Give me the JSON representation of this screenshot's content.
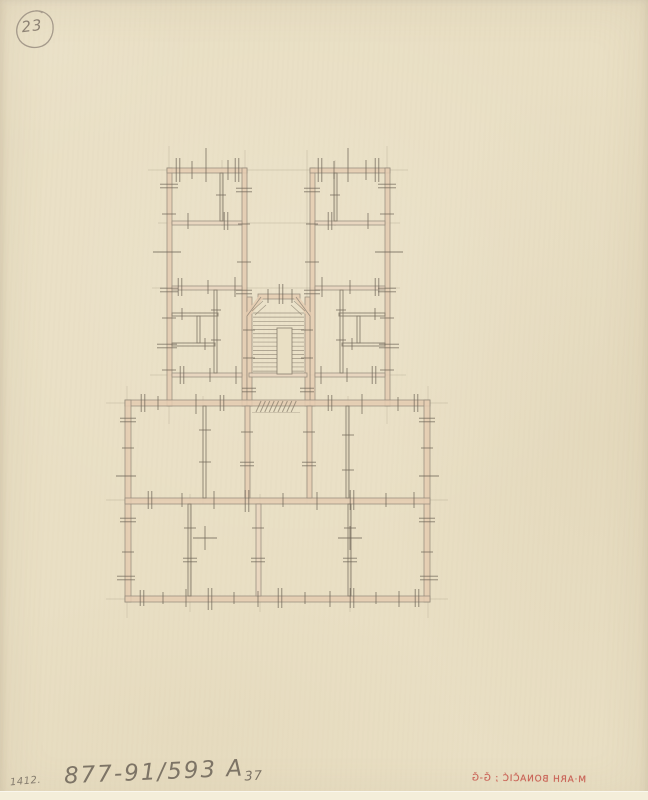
{
  "annotations": {
    "sheet_number": "23",
    "index_number": "1412.",
    "catalog_number": "877-91/593 A",
    "catalog_suffix": "37",
    "stamp_text": "M·ARH BONAČIĆ ; Ǧ-Ǧ"
  },
  "colors": {
    "paper": "#e9dfc4",
    "wall_fill": "#e5ccb2",
    "wall_fill_light": "#ead6c0",
    "wall_edge": "#94897a",
    "pencil": "#847a6a",
    "tick": "#6e6557",
    "construction": "#aba08a",
    "badge_line": "#a59a8b",
    "stamp_red": "#c3473e"
  },
  "floor_plan": {
    "walls": [
      [
        167,
        168,
        5,
        238,
        "p"
      ],
      [
        167,
        168,
        80,
        5,
        "p"
      ],
      [
        242,
        168,
        5,
        238,
        "p"
      ],
      [
        310,
        168,
        5,
        238,
        "p"
      ],
      [
        310,
        168,
        80,
        5,
        "p"
      ],
      [
        385,
        168,
        5,
        238,
        "p"
      ],
      [
        247,
        297,
        5,
        109,
        "p"
      ],
      [
        258,
        294,
        42,
        5,
        "p"
      ],
      [
        305,
        297,
        5,
        109,
        "p"
      ],
      [
        249,
        373,
        58,
        4,
        "P"
      ],
      [
        172,
        221,
        70,
        4,
        "P"
      ],
      [
        315,
        221,
        70,
        4,
        "P"
      ],
      [
        172,
        286,
        70,
        4,
        "P"
      ],
      [
        315,
        286,
        70,
        4,
        "P"
      ],
      [
        172,
        373,
        70,
        4,
        "P"
      ],
      [
        315,
        373,
        70,
        4,
        "P"
      ],
      [
        125,
        400,
        305,
        6,
        "p"
      ],
      [
        125,
        400,
        6,
        202,
        "p"
      ],
      [
        424,
        400,
        6,
        202,
        "p"
      ],
      [
        125,
        596,
        305,
        6,
        "p"
      ],
      [
        125,
        498,
        305,
        6,
        "p"
      ],
      [
        245,
        406,
        5,
        92,
        "p"
      ],
      [
        307,
        406,
        5,
        92,
        "p"
      ],
      [
        256,
        504,
        5,
        92,
        "P"
      ],
      [
        220,
        173,
        3,
        48,
        "g"
      ],
      [
        334,
        173,
        3,
        48,
        "g"
      ],
      [
        172,
        313,
        46,
        3,
        "g"
      ],
      [
        339,
        313,
        46,
        3,
        "g"
      ],
      [
        214,
        290,
        3,
        83,
        "g"
      ],
      [
        340,
        290,
        3,
        83,
        "g"
      ],
      [
        172,
        343,
        43,
        3,
        "g"
      ],
      [
        342,
        343,
        43,
        3,
        "g"
      ],
      [
        197,
        316,
        3,
        27,
        "g"
      ],
      [
        357,
        316,
        3,
        27,
        "g"
      ],
      [
        203,
        406,
        3,
        92,
        "g"
      ],
      [
        346,
        406,
        3,
        92,
        "g"
      ],
      [
        188,
        504,
        3,
        92,
        "g"
      ],
      [
        348,
        504,
        3,
        92,
        "g"
      ]
    ],
    "construction": [
      [
        "h",
        170,
        148,
        408
      ],
      [
        "h",
        223,
        158,
        400
      ],
      [
        "h",
        288,
        152,
        400
      ],
      [
        "h",
        375,
        150,
        406
      ],
      [
        "h",
        403,
        106,
        448
      ],
      [
        "h",
        500,
        106,
        448
      ],
      [
        "h",
        599,
        106,
        448
      ],
      [
        "v",
        127,
        386,
        618
      ],
      [
        "v",
        169,
        146,
        424
      ],
      [
        "v",
        245,
        150,
        504
      ],
      [
        "v",
        307,
        150,
        504
      ],
      [
        "v",
        387,
        146,
        424
      ],
      [
        "v",
        428,
        386,
        618
      ],
      [
        "v",
        203,
        396,
        504
      ],
      [
        "v",
        348,
        396,
        504
      ],
      [
        "v",
        190,
        494,
        612
      ],
      [
        "v",
        260,
        494,
        612
      ],
      [
        "v",
        350,
        494,
        612
      ],
      [
        "v",
        222,
        160,
        226
      ],
      [
        "v",
        335,
        160,
        226
      ]
    ],
    "chamfers": [
      [
        247,
        316,
        261,
        297
      ],
      [
        310,
        316,
        296,
        297
      ]
    ],
    "stair": {
      "x1": 253,
      "x2": 304,
      "y_start": 313,
      "count": 15,
      "step": 4.15,
      "well": [
        277,
        328,
        15,
        46
      ],
      "extra": [
        [
          252,
          311,
          263,
          301
        ],
        [
          305,
          311,
          294,
          301
        ],
        [
          255,
          315,
          266,
          305
        ],
        [
          302,
          315,
          291,
          305
        ]
      ]
    },
    "hatch": {
      "x0": 256,
      "dx": 4.4,
      "n": 9,
      "y_top": 401,
      "y_bot": 412,
      "underline": [
        252,
        412.5,
        300,
        412.5
      ]
    },
    "ticks": [
      [
        178,
        170,
        "v",
        24,
        "d"
      ],
      [
        192,
        170,
        "v",
        18,
        "s"
      ],
      [
        206,
        165,
        "v",
        34,
        "s"
      ],
      [
        228,
        170,
        "v",
        20,
        "s"
      ],
      [
        237,
        170,
        "v",
        24,
        "d"
      ],
      [
        320,
        170,
        "v",
        24,
        "d"
      ],
      [
        334,
        170,
        "v",
        18,
        "s"
      ],
      [
        348,
        165,
        "v",
        34,
        "s"
      ],
      [
        366,
        170,
        "v",
        20,
        "s"
      ],
      [
        377,
        170,
        "v",
        24,
        "d"
      ],
      [
        188,
        221,
        "v",
        16,
        "s"
      ],
      [
        226,
        221,
        "v",
        18,
        "d"
      ],
      [
        330,
        221,
        "v",
        18,
        "d"
      ],
      [
        368,
        221,
        "v",
        16,
        "s"
      ],
      [
        180,
        287,
        "v",
        18,
        "d"
      ],
      [
        208,
        287,
        "v",
        14,
        "s"
      ],
      [
        235,
        287,
        "v",
        20,
        "s"
      ],
      [
        322,
        287,
        "v",
        20,
        "s"
      ],
      [
        350,
        287,
        "v",
        14,
        "s"
      ],
      [
        377,
        287,
        "v",
        18,
        "d"
      ],
      [
        182,
        314,
        "v",
        12,
        "s"
      ],
      [
        205,
        344,
        "v",
        12,
        "s"
      ],
      [
        375,
        314,
        "v",
        12,
        "s"
      ],
      [
        352,
        344,
        "v",
        12,
        "s"
      ],
      [
        182,
        375,
        "v",
        18,
        "d"
      ],
      [
        210,
        375,
        "v",
        14,
        "s"
      ],
      [
        236,
        375,
        "v",
        18,
        "s"
      ],
      [
        321,
        375,
        "v",
        18,
        "s"
      ],
      [
        347,
        375,
        "v",
        14,
        "s"
      ],
      [
        374,
        375,
        "v",
        18,
        "d"
      ],
      [
        268,
        296,
        "v",
        14,
        "s"
      ],
      [
        281,
        294,
        "v",
        20,
        "d"
      ],
      [
        292,
        296,
        "v",
        14,
        "s"
      ],
      [
        143,
        403,
        "v",
        18,
        "d"
      ],
      [
        158,
        403,
        "v",
        14,
        "s"
      ],
      [
        196,
        404,
        "v",
        20,
        "s"
      ],
      [
        222,
        403,
        "v",
        16,
        "d"
      ],
      [
        330,
        403,
        "v",
        16,
        "d"
      ],
      [
        362,
        404,
        "v",
        20,
        "s"
      ],
      [
        398,
        404,
        "v",
        14,
        "s"
      ],
      [
        416,
        403,
        "v",
        18,
        "d"
      ],
      [
        150,
        500,
        "v",
        18,
        "d"
      ],
      [
        182,
        500,
        "v",
        14,
        "s"
      ],
      [
        214,
        500,
        "v",
        18,
        "s"
      ],
      [
        247,
        501,
        "v",
        22,
        "d"
      ],
      [
        283,
        500,
        "v",
        14,
        "s"
      ],
      [
        317,
        501,
        "v",
        18,
        "s"
      ],
      [
        352,
        500,
        "v",
        20,
        "d"
      ],
      [
        386,
        500,
        "v",
        14,
        "s"
      ],
      [
        414,
        500,
        "v",
        16,
        "s"
      ],
      [
        142,
        598,
        "v",
        16,
        "d"
      ],
      [
        163,
        598,
        "v",
        12,
        "s"
      ],
      [
        186,
        598,
        "v",
        18,
        "s"
      ],
      [
        210,
        599,
        "v",
        22,
        "d"
      ],
      [
        234,
        598,
        "v",
        12,
        "s"
      ],
      [
        258,
        599,
        "v",
        16,
        "s"
      ],
      [
        280,
        598,
        "v",
        20,
        "d"
      ],
      [
        305,
        598,
        "v",
        12,
        "s"
      ],
      [
        330,
        599,
        "v",
        16,
        "s"
      ],
      [
        352,
        598,
        "v",
        20,
        "d"
      ],
      [
        376,
        598,
        "v",
        12,
        "s"
      ],
      [
        399,
        599,
        "v",
        16,
        "s"
      ],
      [
        417,
        598,
        "v",
        18,
        "d"
      ],
      [
        205,
        538,
        "v",
        24,
        "s"
      ],
      [
        350,
        538,
        "v",
        24,
        "s"
      ],
      [
        169,
        186,
        "h",
        18,
        "d"
      ],
      [
        169,
        214,
        "h",
        14,
        "s"
      ],
      [
        167,
        252,
        "h",
        28,
        "s"
      ],
      [
        169,
        290,
        "h",
        18,
        "d"
      ],
      [
        169,
        318,
        "h",
        14,
        "s"
      ],
      [
        167,
        346,
        "h",
        20,
        "d"
      ],
      [
        169,
        370,
        "h",
        14,
        "s"
      ],
      [
        244,
        190,
        "h",
        16,
        "d"
      ],
      [
        244,
        224,
        "h",
        12,
        "s"
      ],
      [
        244,
        262,
        "h",
        14,
        "s"
      ],
      [
        244,
        292,
        "h",
        16,
        "d"
      ],
      [
        312,
        190,
        "h",
        16,
        "d"
      ],
      [
        312,
        224,
        "h",
        12,
        "s"
      ],
      [
        312,
        262,
        "h",
        14,
        "s"
      ],
      [
        312,
        292,
        "h",
        16,
        "d"
      ],
      [
        387,
        186,
        "h",
        18,
        "d"
      ],
      [
        387,
        214,
        "h",
        14,
        "s"
      ],
      [
        389,
        252,
        "h",
        28,
        "s"
      ],
      [
        387,
        290,
        "h",
        18,
        "d"
      ],
      [
        387,
        318,
        "h",
        14,
        "s"
      ],
      [
        389,
        346,
        "h",
        20,
        "d"
      ],
      [
        387,
        370,
        "h",
        14,
        "s"
      ],
      [
        249,
        330,
        "h",
        12,
        "s"
      ],
      [
        249,
        358,
        "h",
        12,
        "s"
      ],
      [
        307,
        330,
        "h",
        12,
        "s"
      ],
      [
        307,
        358,
        "h",
        12,
        "s"
      ],
      [
        249,
        390,
        "h",
        14,
        "d"
      ],
      [
        307,
        390,
        "h",
        14,
        "d"
      ],
      [
        128,
        420,
        "h",
        16,
        "d"
      ],
      [
        128,
        448,
        "h",
        12,
        "s"
      ],
      [
        126,
        476,
        "h",
        20,
        "s"
      ],
      [
        128,
        520,
        "h",
        16,
        "d"
      ],
      [
        128,
        552,
        "h",
        12,
        "s"
      ],
      [
        126,
        578,
        "h",
        18,
        "d"
      ],
      [
        427,
        420,
        "h",
        16,
        "d"
      ],
      [
        427,
        448,
        "h",
        12,
        "s"
      ],
      [
        429,
        476,
        "h",
        20,
        "s"
      ],
      [
        427,
        520,
        "h",
        16,
        "d"
      ],
      [
        427,
        552,
        "h",
        12,
        "s"
      ],
      [
        429,
        578,
        "h",
        18,
        "d"
      ],
      [
        247,
        432,
        "h",
        12,
        "s"
      ],
      [
        247,
        464,
        "h",
        14,
        "d"
      ],
      [
        309,
        432,
        "h",
        12,
        "s"
      ],
      [
        309,
        464,
        "h",
        14,
        "d"
      ],
      [
        348,
        435,
        "h",
        12,
        "s"
      ],
      [
        348,
        470,
        "h",
        12,
        "s"
      ],
      [
        205,
        430,
        "h",
        12,
        "s"
      ],
      [
        205,
        462,
        "h",
        12,
        "s"
      ],
      [
        190,
        528,
        "h",
        12,
        "s"
      ],
      [
        190,
        560,
        "h",
        14,
        "d"
      ],
      [
        258,
        528,
        "h",
        12,
        "s"
      ],
      [
        258,
        560,
        "h",
        14,
        "d"
      ],
      [
        350,
        528,
        "h",
        12,
        "s"
      ],
      [
        350,
        560,
        "h",
        14,
        "d"
      ],
      [
        221,
        195,
        "h",
        10,
        "s"
      ],
      [
        335,
        195,
        "h",
        10,
        "s"
      ],
      [
        216,
        310,
        "h",
        10,
        "s"
      ],
      [
        216,
        340,
        "h",
        10,
        "s"
      ],
      [
        341,
        310,
        "h",
        10,
        "s"
      ],
      [
        341,
        340,
        "h",
        10,
        "s"
      ],
      [
        205,
        538,
        "h",
        24,
        "s"
      ],
      [
        350,
        538,
        "h",
        24,
        "s"
      ]
    ]
  }
}
